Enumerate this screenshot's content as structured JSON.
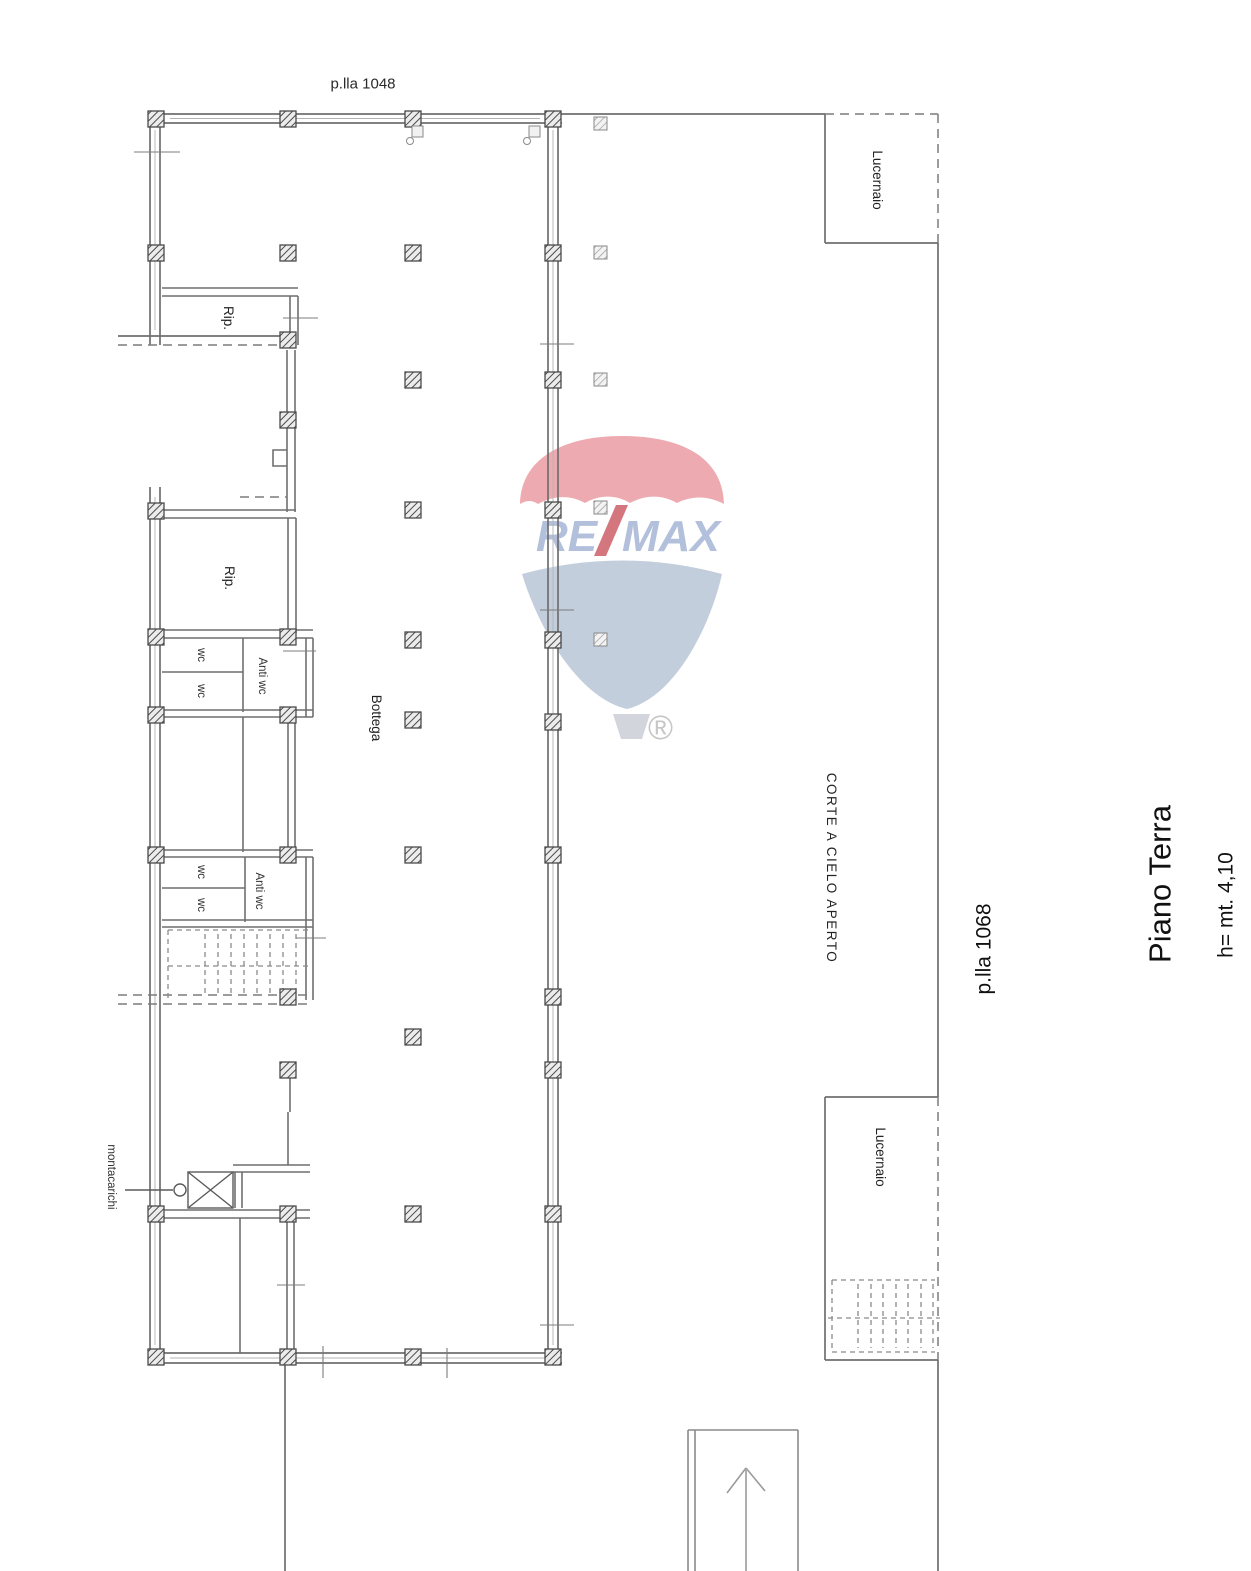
{
  "plan": {
    "parcel_top": "p.lla 1048",
    "parcel_courtyard": "p.lla 1068",
    "floor_title": "Piano Terra",
    "floor_height": "h= mt. 4,10",
    "rooms": {
      "skylight_top": "Lucernaio",
      "skylight_bottom": "Lucernaio",
      "storage_top": "Rip.",
      "storage_mid": "Rip.",
      "wc_top_1": "wc",
      "wc_top_2": "wc",
      "anti_wc_top": "Anti wc",
      "wc_low_1": "wc",
      "wc_low_2": "wc",
      "anti_wc_low": "Anti wc",
      "shop": "Bottega",
      "courtyard": "CORTE A CIELO APERTO",
      "freight_elevator": "montacarichi"
    },
    "colors": {
      "wall_line": "#6f6f6f",
      "dashed_line": "#7c7c7c",
      "column_hatch": "#4a4a4a",
      "text": "#232323"
    }
  },
  "watermark": {
    "brand_left": "RE",
    "brand_right": "MAX",
    "registered_mark": "®",
    "colors": {
      "dome_red": "#edaab0",
      "letters_blue": "#b3c0dc",
      "slash_red": "#d4767e",
      "fan_blue": "#c3cedd",
      "basket_gray": "#d2d5dc"
    }
  }
}
